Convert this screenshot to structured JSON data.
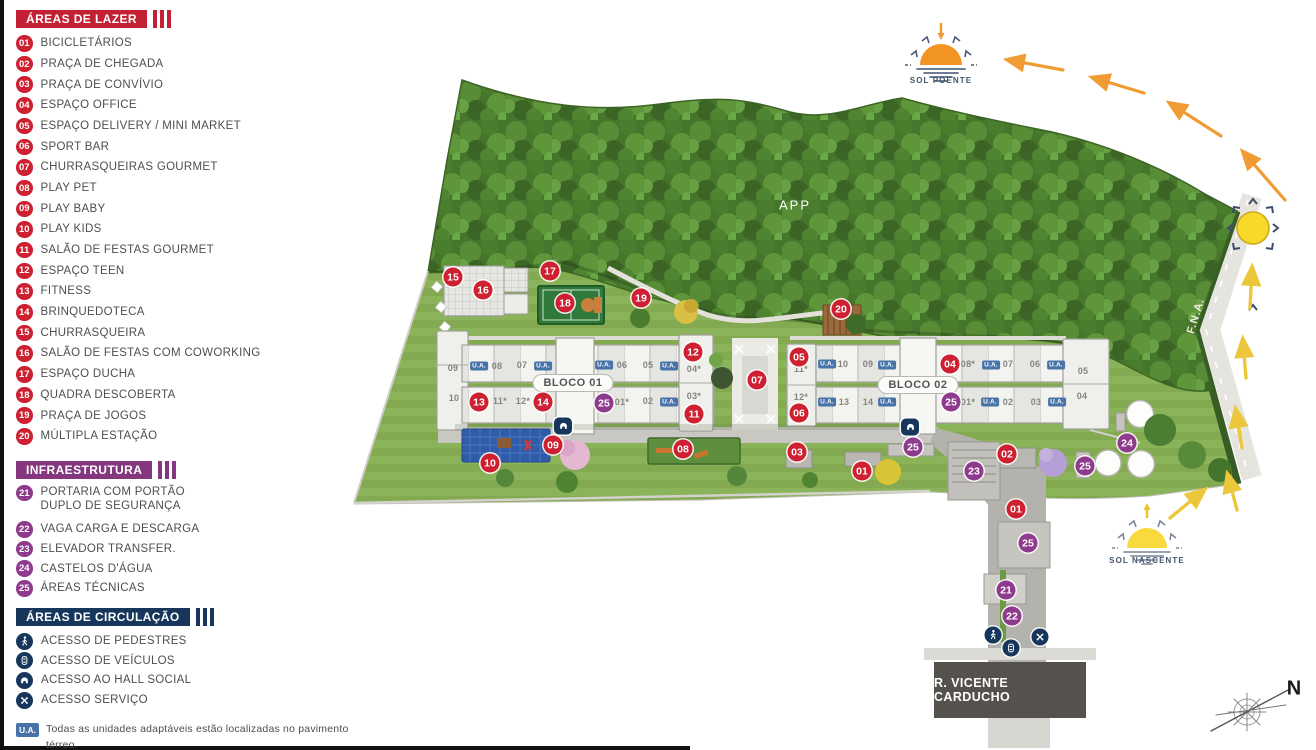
{
  "colors": {
    "red": "#ce2030",
    "purple": "#8f3b8d",
    "navy": "#16365c",
    "ua_blue": "#4873a8",
    "orange": "#f29422",
    "yellow": "#f3d53a"
  },
  "legend": {
    "sections": {
      "lazer": {
        "title": "ÁREAS DE LAZER",
        "items": [
          {
            "num": "01",
            "label": "BICICLETÁRIOS"
          },
          {
            "num": "02",
            "label": "PRAÇA DE CHEGADA"
          },
          {
            "num": "03",
            "label": "PRAÇA DE CONVÍVIO"
          },
          {
            "num": "04",
            "label": "ESPAÇO OFFICE"
          },
          {
            "num": "05",
            "label": "ESPAÇO DELIVERY / MINI MARKET"
          },
          {
            "num": "06",
            "label": "SPORT BAR"
          },
          {
            "num": "07",
            "label": "CHURRASQUEIRAS GOURMET"
          },
          {
            "num": "08",
            "label": "PLAY PET"
          },
          {
            "num": "09",
            "label": "PLAY BABY"
          },
          {
            "num": "10",
            "label": "PLAY KIDS"
          },
          {
            "num": "11",
            "label": "SALÃO DE FESTAS GOURMET"
          },
          {
            "num": "12",
            "label": "ESPAÇO TEEN"
          },
          {
            "num": "13",
            "label": "FITNESS"
          },
          {
            "num": "14",
            "label": "BRINQUEDOTECA"
          },
          {
            "num": "15",
            "label": "CHURRASQUEIRA"
          },
          {
            "num": "16",
            "label": "SALÃO DE FESTAS COM COWORKING"
          },
          {
            "num": "17",
            "label": "ESPAÇO DUCHA"
          },
          {
            "num": "18",
            "label": "QUADRA DESCOBERTA"
          },
          {
            "num": "19",
            "label": "PRAÇA DE JOGOS"
          },
          {
            "num": "20",
            "label": "MÚLTIPLA ESTAÇÃO"
          }
        ]
      },
      "infra": {
        "title": "INFRAESTRUTURA",
        "items": [
          {
            "num": "21",
            "label": "PORTARIA COM PORTÃO\nDUPLO DE SEGURANÇA",
            "tall": true
          },
          {
            "num": "22",
            "label": "VAGA CARGA E DESCARGA"
          },
          {
            "num": "23",
            "label": "ELEVADOR TRANSFER."
          },
          {
            "num": "24",
            "label": "CASTELOS D'ÁGUA"
          },
          {
            "num": "25",
            "label": "ÁREAS TÉCNICAS"
          }
        ]
      },
      "circ": {
        "title": "ÁREAS DE CIRCULAÇÃO",
        "items": [
          {
            "icon": "pedestrian",
            "label": "ACESSO DE PEDESTRES"
          },
          {
            "icon": "vehicle",
            "label": "ACESSO DE VEÍCULOS"
          },
          {
            "icon": "hall",
            "label": "ACESSO AO HALL SOCIAL"
          },
          {
            "icon": "service",
            "label": "ACESSO SERVIÇO"
          }
        ]
      }
    },
    "footnote": {
      "badge": "U.A.",
      "line1": "Todas as unidades adaptáveis estão localizadas no pavimento térreo.",
      "line2": "* Unidades habitacionais a partir do 1º pav."
    }
  },
  "map": {
    "app_label": "APP",
    "fna_label": "F.N.A.",
    "street_label": "R. VICENTE CARDUCHO",
    "compass_n": "N",
    "ua_text": "U.A.",
    "suns": {
      "poente": "SOL POENTE",
      "nascente": "SOL NASCENTE"
    },
    "blocks": [
      {
        "name": "BLOCO 01",
        "x": 573,
        "y": 383
      },
      {
        "name": "BLOCO 02",
        "x": 918,
        "y": 385
      }
    ],
    "badges": [
      {
        "n": "15",
        "c": "red",
        "x": 453,
        "y": 277
      },
      {
        "n": "16",
        "c": "red",
        "x": 483,
        "y": 290
      },
      {
        "n": "17",
        "c": "red",
        "x": 550,
        "y": 271
      },
      {
        "n": "18",
        "c": "red",
        "x": 565,
        "y": 303
      },
      {
        "n": "19",
        "c": "red",
        "x": 641,
        "y": 298
      },
      {
        "n": "20",
        "c": "red",
        "x": 841,
        "y": 309
      },
      {
        "n": "12",
        "c": "red",
        "x": 693,
        "y": 352
      },
      {
        "n": "11",
        "c": "red",
        "x": 694,
        "y": 414
      },
      {
        "n": "13",
        "c": "red",
        "x": 479,
        "y": 402
      },
      {
        "n": "14",
        "c": "red",
        "x": 543,
        "y": 402
      },
      {
        "n": "05",
        "c": "red",
        "x": 799,
        "y": 357
      },
      {
        "n": "06",
        "c": "red",
        "x": 799,
        "y": 413
      },
      {
        "n": "07",
        "c": "red",
        "x": 757,
        "y": 380
      },
      {
        "n": "04",
        "c": "red",
        "x": 950,
        "y": 364
      },
      {
        "n": "09",
        "c": "red",
        "x": 553,
        "y": 445
      },
      {
        "n": "10",
        "c": "red",
        "x": 490,
        "y": 463
      },
      {
        "n": "08",
        "c": "red",
        "x": 683,
        "y": 449
      },
      {
        "n": "03",
        "c": "red",
        "x": 797,
        "y": 452
      },
      {
        "n": "01",
        "c": "red",
        "x": 862,
        "y": 471
      },
      {
        "n": "02",
        "c": "red",
        "x": 1007,
        "y": 454
      },
      {
        "n": "01",
        "c": "red",
        "x": 1016,
        "y": 509
      },
      {
        "n": "25",
        "c": "pur",
        "x": 604,
        "y": 403
      },
      {
        "n": "25",
        "c": "pur",
        "x": 951,
        "y": 402
      },
      {
        "n": "25",
        "c": "pur",
        "x": 913,
        "y": 447
      },
      {
        "n": "23",
        "c": "pur",
        "x": 974,
        "y": 471
      },
      {
        "n": "24",
        "c": "pur",
        "x": 1127,
        "y": 443
      },
      {
        "n": "25",
        "c": "pur",
        "x": 1085,
        "y": 466
      },
      {
        "n": "25",
        "c": "pur",
        "x": 1028,
        "y": 543
      },
      {
        "n": "21",
        "c": "pur",
        "x": 1006,
        "y": 590
      },
      {
        "n": "22",
        "c": "pur",
        "x": 1012,
        "y": 616
      }
    ],
    "unit_labels": [
      {
        "t": "09",
        "x": 453,
        "y": 368
      },
      {
        "t": "10",
        "x": 454,
        "y": 398
      },
      {
        "t": "08",
        "x": 497,
        "y": 366
      },
      {
        "t": "07",
        "x": 522,
        "y": 365
      },
      {
        "t": "06",
        "x": 622,
        "y": 365
      },
      {
        "t": "05",
        "x": 648,
        "y": 365
      },
      {
        "t": "04*",
        "x": 694,
        "y": 369
      },
      {
        "t": "03*",
        "x": 694,
        "y": 396
      },
      {
        "t": "11*",
        "x": 500,
        "y": 401
      },
      {
        "t": "12*",
        "x": 523,
        "y": 401
      },
      {
        "t": "01*",
        "x": 622,
        "y": 402
      },
      {
        "t": "02",
        "x": 648,
        "y": 401
      },
      {
        "t": "11*",
        "x": 801,
        "y": 369
      },
      {
        "t": "12*",
        "x": 801,
        "y": 397
      },
      {
        "t": "10",
        "x": 843,
        "y": 364
      },
      {
        "t": "09",
        "x": 868,
        "y": 364
      },
      {
        "t": "08*",
        "x": 968,
        "y": 364
      },
      {
        "t": "07",
        "x": 1008,
        "y": 364
      },
      {
        "t": "06",
        "x": 1035,
        "y": 364
      },
      {
        "t": "13",
        "x": 844,
        "y": 402
      },
      {
        "t": "14",
        "x": 868,
        "y": 402
      },
      {
        "t": "01*",
        "x": 968,
        "y": 402
      },
      {
        "t": "02",
        "x": 1008,
        "y": 402
      },
      {
        "t": "03",
        "x": 1036,
        "y": 402
      },
      {
        "t": "05",
        "x": 1083,
        "y": 371
      },
      {
        "t": "04",
        "x": 1082,
        "y": 396
      }
    ],
    "ua_positions": [
      {
        "x": 479,
        "y": 366
      },
      {
        "x": 543,
        "y": 366
      },
      {
        "x": 604,
        "y": 365
      },
      {
        "x": 669,
        "y": 366
      },
      {
        "x": 669,
        "y": 402
      },
      {
        "x": 827,
        "y": 364
      },
      {
        "x": 887,
        "y": 365
      },
      {
        "x": 991,
        "y": 365
      },
      {
        "x": 1056,
        "y": 365
      },
      {
        "x": 827,
        "y": 402
      },
      {
        "x": 887,
        "y": 402
      },
      {
        "x": 990,
        "y": 402
      },
      {
        "x": 1057,
        "y": 402
      }
    ],
    "access": [
      {
        "icon": "hall",
        "x": 563,
        "y": 426
      },
      {
        "icon": "hall",
        "x": 910,
        "y": 427
      },
      {
        "icon": "pedestrian",
        "x": 993,
        "y": 635
      },
      {
        "icon": "vehicle",
        "x": 1011,
        "y": 648
      },
      {
        "icon": "service",
        "x": 1040,
        "y": 637
      }
    ]
  }
}
